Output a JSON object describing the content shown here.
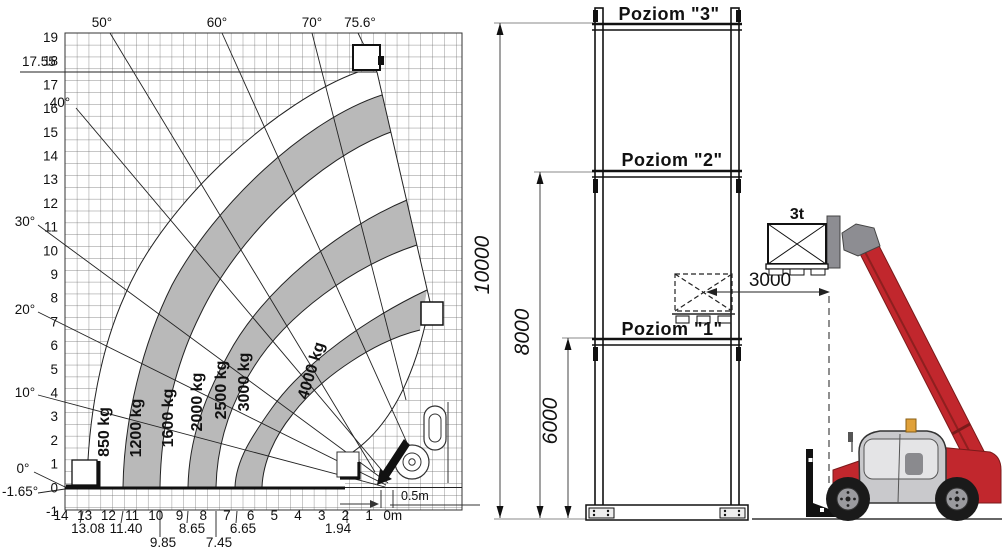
{
  "load_chart": {
    "y_ticks": [
      "19",
      "18",
      "17",
      "16",
      "15",
      "14",
      "13",
      "12",
      "11",
      "10",
      "9",
      "8",
      "7",
      "6",
      "5",
      "4",
      "3",
      "2",
      "1",
      "0",
      "-1"
    ],
    "x_ticks": [
      "14",
      "13",
      "12",
      "11",
      "10",
      "9",
      "8",
      "7",
      "6",
      "5",
      "4",
      "3",
      "2",
      "1",
      "0m"
    ],
    "max_height": "17.55",
    "angle_labels": {
      "a50": "50°",
      "a60": "60°",
      "a70": "70°",
      "a756": "75.6°",
      "a40": "40°",
      "a30": "30°",
      "a20": "20°",
      "a10": "10°",
      "a0": "0°",
      "aneg": "-1.65°"
    },
    "reach_marks": {
      "r1308": "13.08",
      "r1140": "11.40",
      "r985": "9.85",
      "r865": "8.65",
      "r745": "7.45",
      "r665": "6.65",
      "r194": "1.94"
    },
    "zones": {
      "z850": "850 kg",
      "z1200": "1200 kg",
      "z1600": "1600 kg",
      "z2000": "2000 kg",
      "z2500": "2500 kg",
      "z3000": "3000 kg",
      "z4000": "4000 kg"
    },
    "offset": "0.5m"
  },
  "rack": {
    "level3": "Poziom \"3\"",
    "level2": "Poziom \"2\"",
    "level1": "Poziom \"1\"",
    "dim_total": "10000",
    "dim_mid": "8000",
    "dim_low": "6000",
    "dim_reach": "3000",
    "load": "3t"
  },
  "chart_data": {
    "type": "area",
    "title": "Telehandler load capacity envelope",
    "xlabel": "reach (m)",
    "ylabel": "lift height (m)",
    "xlim": [
      14,
      0
    ],
    "ylim": [
      -1,
      19
    ],
    "grid": true,
    "max_lift_height_m": 17.55,
    "boom_angles_deg": [
      -1.65,
      0,
      10,
      20,
      30,
      40,
      50,
      60,
      70,
      75.6
    ],
    "capacity_zones_kg": [
      850,
      1200,
      1600,
      2000,
      2500,
      3000,
      4000
    ],
    "reach_marks_m": [
      13.08,
      11.4,
      9.85,
      8.65,
      7.45,
      6.65,
      1.94
    ],
    "fork_offset_m": 0.5,
    "rack_levels_mm": [
      6000,
      8000,
      10000
    ],
    "rack_reach_mm": 3000,
    "rack_load_t": 3
  },
  "colors": {
    "zone_gray": "#b9b9b9",
    "line": "#1a1a1a",
    "machine_red": "#c1272d",
    "cab_gray": "#c9c9cc",
    "beacon_yellow": "#e0a13a"
  }
}
